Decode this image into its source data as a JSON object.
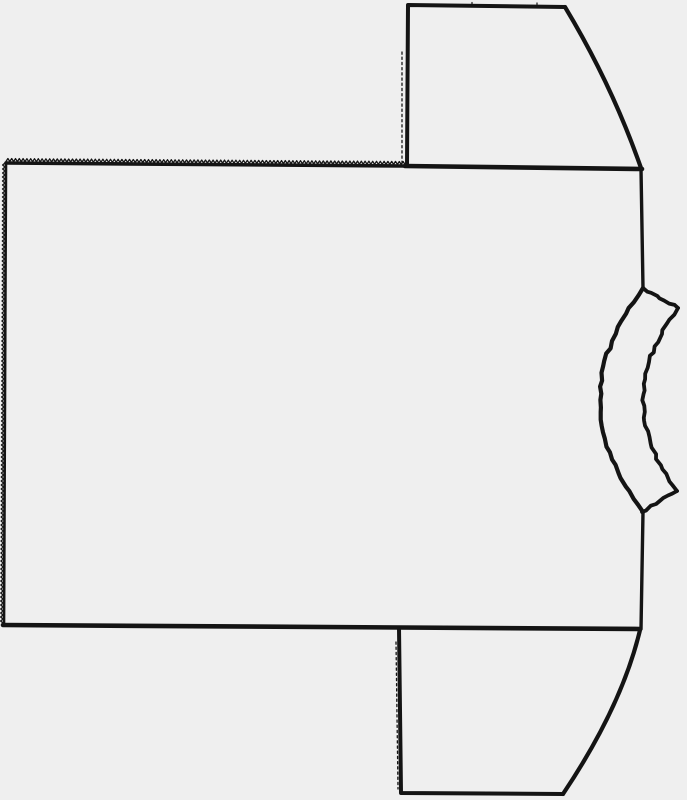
{
  "drawing": {
    "canvas": {
      "width": 687,
      "height": 800
    },
    "background_color": "#efefef",
    "stroke_color": "#141414",
    "groups": {
      "pattern-piece-body": {
        "shapes": [
          {
            "type": "serrated",
            "from": [
              6,
              163
            ],
            "to": [
              405,
              166
            ],
            "dir": [
              0,
              -1
            ],
            "amp": 3,
            "period": 3.8,
            "width": 3.6
          },
          {
            "type": "serrated",
            "from": [
              6,
              163
            ],
            "to": [
              4,
              625
            ],
            "dir": [
              -1,
              0
            ],
            "amp": 2.4,
            "period": 4,
            "width": 2.6
          },
          {
            "type": "line",
            "from": [
              405,
              166
            ],
            "to": [
              642,
              169
            ],
            "width": 4.6
          },
          {
            "type": "line",
            "from": [
              641,
              169
            ],
            "to": [
              643,
              288
            ],
            "width": 3.4
          },
          {
            "type": "line",
            "from": [
              643,
              512
            ],
            "to": [
              641,
              629
            ],
            "width": 3.4
          },
          {
            "type": "line",
            "from": [
              640,
              629
            ],
            "to": [
              3,
              625
            ],
            "width": 4.6
          }
        ]
      },
      "pattern-piece-sleeve-top": {
        "shapes": [
          {
            "type": "polyline",
            "points": [
              [
                407,
                166
              ],
              [
                408,
                5
              ],
              [
                565,
                7
              ]
            ],
            "width": 4
          },
          {
            "type": "quad",
            "from": [
              565,
              7
            ],
            "ctrl": [
              612,
              85
            ],
            "to": [
              641,
              168
            ],
            "width": 4.2
          },
          {
            "type": "dotted",
            "from": [
              402,
              52
            ],
            "to": [
              402,
              163
            ],
            "width": 1.3,
            "dash": "2.2 3"
          },
          {
            "type": "line",
            "from": [
              472,
              2.5
            ],
            "to": [
              472,
              6.5
            ],
            "width": 1.2
          },
          {
            "type": "line",
            "from": [
              537,
              3
            ],
            "to": [
              537,
              7.5
            ],
            "width": 1.2
          }
        ]
      },
      "pattern-piece-sleeve-bottom": {
        "shapes": [
          {
            "type": "polyline",
            "points": [
              [
                399,
                628
              ],
              [
                401,
                793
              ],
              [
                563,
                794
              ]
            ],
            "width": 4
          },
          {
            "type": "quad",
            "from": [
              563,
              794
            ],
            "ctrl": [
              622,
              706
            ],
            "to": [
              640,
              630
            ],
            "width": 4.2
          },
          {
            "type": "dotted",
            "from": [
              396,
              642
            ],
            "to": [
              398,
              789
            ],
            "width": 1.3,
            "dash": "2.2 3"
          }
        ]
      },
      "pattern-piece-neckband": {
        "shapes": [
          {
            "type": "rough-line",
            "from": [
              643,
              288
            ],
            "to": [
              678,
              308
            ],
            "width": 3.8,
            "amp": 1.3
          },
          {
            "type": "rough-quad",
            "from": [
              678,
              308
            ],
            "ctrl": [
              608.5,
              401
            ],
            "to": [
              677,
              491
            ],
            "width": 3.8,
            "amp": 1.5
          },
          {
            "type": "rough-line",
            "from": [
              677,
              491
            ],
            "to": [
              642,
              512
            ],
            "width": 3.8,
            "amp": 1.3
          },
          {
            "type": "rough-quad",
            "from": [
              643,
              288
            ],
            "ctrl": [
              557,
              400
            ],
            "to": [
              643,
              512
            ],
            "width": 4.2,
            "amp": 1.2
          }
        ]
      }
    }
  }
}
